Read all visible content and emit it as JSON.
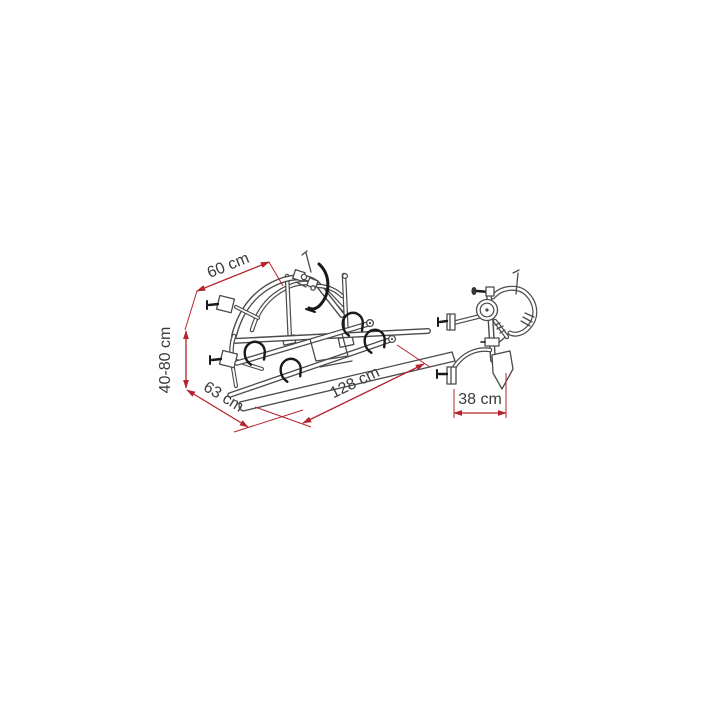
{
  "canvas": {
    "width": 720,
    "height": 720,
    "background": "#ffffff"
  },
  "colors": {
    "dimension_lines": "#b5232e",
    "artwork_lines": "#4a4a4a",
    "dark_details": "#191919",
    "label_text": "#3a3a3a"
  },
  "diagram": {
    "type": "technical-dimension-drawing",
    "subject": "rear-mounted bike carrier",
    "views": [
      {
        "id": "main-perspective-view"
      },
      {
        "id": "side-profile-view"
      }
    ],
    "dimensions": [
      {
        "id": "dim-top-width",
        "label": "60 cm"
      },
      {
        "id": "dim-height-range",
        "label": "40-80 cm"
      },
      {
        "id": "dim-depth",
        "label": "63 cm"
      },
      {
        "id": "dim-overall-width",
        "label": "128 cm"
      },
      {
        "id": "dim-side-offset",
        "label": "38 cm"
      }
    ]
  }
}
